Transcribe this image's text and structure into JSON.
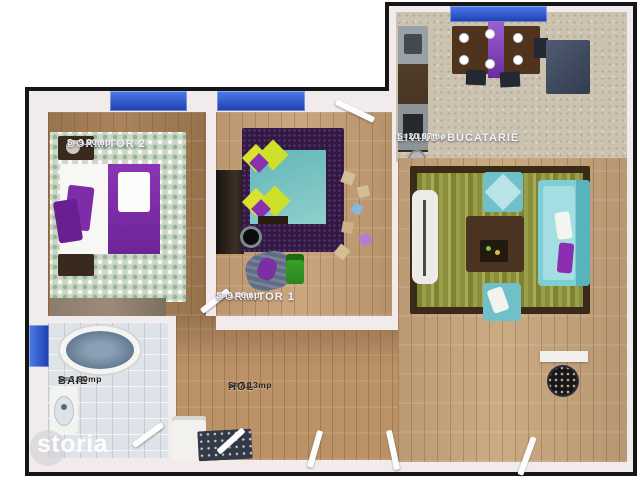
{
  "plan": {
    "type": "apartment-floor-plan",
    "rooms": {
      "dormitor2": {
        "name": "DORMITOR 2",
        "area": "S=9.90mp"
      },
      "dormitor1": {
        "name": "DORMITOR 1",
        "area": "S=9.46mp"
      },
      "living": {
        "name": "LIVING+BUCATARIE",
        "area": "S=20.07mp"
      },
      "baie": {
        "name": "BAIE",
        "area": "S=3.90mp"
      },
      "hol": {
        "name": "HOL",
        "area": "S=7.13mp"
      }
    }
  },
  "watermark": {
    "brand": "storia"
  },
  "palette": {
    "outline": "#161616",
    "window_blue": "#2d55cc",
    "accent_purple": "#7b2fa3",
    "accent_teal": "#74c7cf",
    "rug_olive": "#8e9140",
    "wood": "#c49e72"
  }
}
